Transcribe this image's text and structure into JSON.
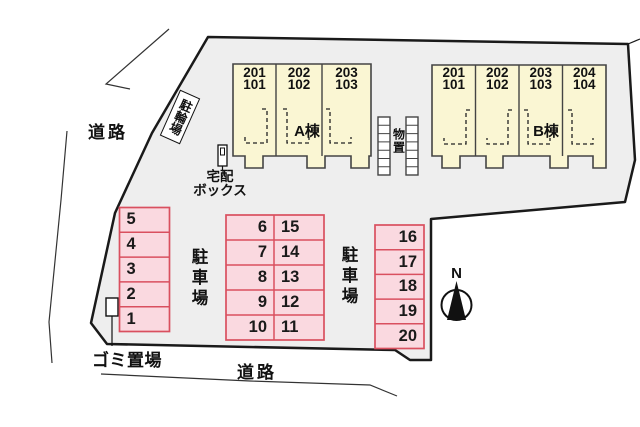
{
  "site": {
    "road_left_label": "道路",
    "road_bottom_label": "道路",
    "bicycle_parking_label": "駐輪場",
    "delivery_box_label_line1": "宅配",
    "delivery_box_label_line2": "ボックス",
    "garbage_area_label": "ゴミ置場",
    "storage_label": "物置",
    "north_label": "N"
  },
  "buildings": {
    "a": {
      "name": "A棟",
      "units": [
        {
          "upper": "201",
          "lower": "101"
        },
        {
          "upper": "202",
          "lower": "102"
        },
        {
          "upper": "203",
          "lower": "103"
        }
      ]
    },
    "b": {
      "name": "B棟",
      "units": [
        {
          "upper": "201",
          "lower": "101"
        },
        {
          "upper": "202",
          "lower": "102"
        },
        {
          "upper": "203",
          "lower": "103"
        },
        {
          "upper": "204",
          "lower": "104"
        }
      ]
    }
  },
  "parking": {
    "label_left": "駐車場",
    "label_right": "駐車場",
    "left_column": [
      "5",
      "4",
      "3",
      "2",
      "1"
    ],
    "center_left_column": [
      "6",
      "7",
      "8",
      "9",
      "10"
    ],
    "center_right_column": [
      "15",
      "14",
      "13",
      "12",
      "11"
    ],
    "right_column": [
      "16",
      "17",
      "18",
      "19",
      "20"
    ]
  },
  "colors": {
    "site_fill": "#eeeeee",
    "boundary_stroke": "#1a1a1a",
    "building_fill": "#faf6d3",
    "building_stroke": "#444444",
    "parking_fill": "#fad9e0",
    "parking_stroke": "#d9505f",
    "storage_fill": "#ffffff",
    "background": "#ffffff"
  }
}
